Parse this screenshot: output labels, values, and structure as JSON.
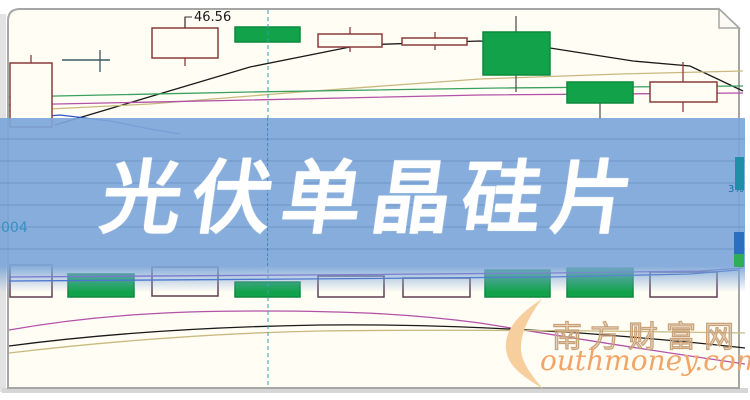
{
  "banner": {
    "text": "光伏单晶硅片",
    "bg_color": "#7ca6d8",
    "code_label": "004",
    "side_pct_label": "3%"
  },
  "annotation": {
    "price_label": "46.56"
  },
  "watermark": {
    "zh": "南方财富网",
    "en": "outhmoney.com",
    "accent": "#f2a568"
  },
  "chart_data": {
    "type": "candlestick",
    "title": "光伏单晶硅片",
    "note": "no visible axes; geometry given in pixel coords of 750x400 image; only labeled value is 46.56",
    "annotation_price": 46.56,
    "crosshair_x": 268,
    "colors": {
      "hollow_candle": "#8a3b3b",
      "green_candle": "#12a34a",
      "green_candle_edge": "#0c8a3e",
      "doji": "#3d5a63",
      "ma_black": "#1a1a1a",
      "ma_tan": "#c9b97e",
      "ma_green": "#3aa060",
      "ma_magenta": "#b352a8",
      "ma_blue": "#2a52c8",
      "vol_outline": "#5f3f52",
      "vol_ma_purple": "#7a3fc0",
      "vol_ma_blue": "#2a52c8",
      "crosshair": "#2f9fae"
    },
    "candles": [
      {
        "kind": "hollow",
        "x": 10,
        "w": 42,
        "y": 63,
        "h": 64,
        "cx": 31,
        "wickTop": 55,
        "wickBot": null
      },
      {
        "kind": "doji",
        "x": 62,
        "w": 48,
        "y": 60,
        "h": 0,
        "cx": 100,
        "wickTop": 50,
        "wickBot": 72
      },
      {
        "kind": "hollow",
        "x": 152,
        "w": 66,
        "y": 28,
        "h": 30,
        "cx": 185,
        "wickTop": 17,
        "wickBot": 66
      },
      {
        "kind": "green",
        "x": 235,
        "w": 65,
        "y": 27,
        "h": 15,
        "cx": 267,
        "wickTop": null,
        "wickBot": null
      },
      {
        "kind": "hollow",
        "x": 318,
        "w": 64,
        "y": 34,
        "h": 13,
        "cx": 350,
        "wickTop": 27,
        "wickBot": 52
      },
      {
        "kind": "hollow",
        "x": 402,
        "w": 65,
        "y": 38,
        "h": 7,
        "cx": 435,
        "wickTop": 32,
        "wickBot": 50
      },
      {
        "kind": "green",
        "x": 483,
        "w": 67,
        "y": 32,
        "h": 43,
        "cx": 516,
        "wickTop": 16,
        "wickBot": 92
      },
      {
        "kind": "green",
        "x": 567,
        "w": 66,
        "y": 82,
        "h": 21,
        "cx": 600,
        "wickTop": null,
        "wickBot": 120
      },
      {
        "kind": "hollow",
        "x": 650,
        "w": 67,
        "y": 82,
        "h": 20,
        "cx": 683,
        "wickTop": 62,
        "wickBot": 112
      }
    ],
    "volume_bars": [
      {
        "kind": "hollow",
        "x": 10,
        "w": 42,
        "y": 265,
        "h": 32
      },
      {
        "kind": "green",
        "x": 68,
        "w": 66,
        "y": 274,
        "h": 23
      },
      {
        "kind": "hollow",
        "x": 152,
        "w": 66,
        "y": 267,
        "h": 29
      },
      {
        "kind": "green",
        "x": 235,
        "w": 65,
        "y": 282,
        "h": 15
      },
      {
        "kind": "hollow",
        "x": 318,
        "w": 66,
        "y": 276,
        "h": 21
      },
      {
        "kind": "hollow",
        "x": 403,
        "w": 67,
        "y": 278,
        "h": 19
      },
      {
        "kind": "green",
        "x": 485,
        "w": 65,
        "y": 270,
        "h": 27
      },
      {
        "kind": "green",
        "x": 567,
        "w": 66,
        "y": 268,
        "h": 29
      },
      {
        "kind": "hollow",
        "x": 650,
        "w": 67,
        "y": 272,
        "h": 25
      }
    ],
    "ma_lines": [
      {
        "name": "ma-black",
        "color": "#1a1a1a",
        "path": "M55,125 L250,67 L360,45 L480,41 L550,48 L633,61 L690,66 L743,91"
      },
      {
        "name": "ma-tan",
        "color": "#c9b97e",
        "path": "M9,111 L150,104 L300,92 L480,79 L620,74 L743,71"
      },
      {
        "name": "ma-green",
        "color": "#3aa060",
        "path": "M9,97 L250,92 L500,88 L743,86"
      },
      {
        "name": "ma-magenta",
        "color": "#b352a8",
        "path": "M9,105 L250,100 L480,95 L743,93"
      },
      {
        "name": "ma-blue",
        "color": "#2a52c8",
        "path": "M9,119 L60,115 L110,121 L150,129 L180,134"
      }
    ],
    "volume_ma_lines": [
      {
        "name": "vol-ma-purple",
        "color": "#7a3fc0",
        "path": "M9,277 L300,275 L550,273 L700,271 L743,268"
      },
      {
        "name": "vol-ma-blue",
        "color": "#2a52c8",
        "path": "M9,281 L300,279 L550,277 L690,274 L738,270"
      }
    ],
    "indicator_curves": [
      {
        "name": "ind-magenta",
        "color": "#b352a8",
        "path": "M9,330 C100,314 180,311 260,311 C360,311 420,315 480,323 C560,336 660,352 745,364"
      },
      {
        "name": "ind-black",
        "color": "#1a1a1a",
        "path": "M9,346 C100,334 200,327 320,325 C420,324 500,328 580,333 C660,339 710,344 745,348"
      },
      {
        "name": "ind-tan",
        "color": "#c9b97e",
        "path": "M9,353 C120,340 220,333 320,331 C470,329 620,331 745,333"
      }
    ]
  }
}
